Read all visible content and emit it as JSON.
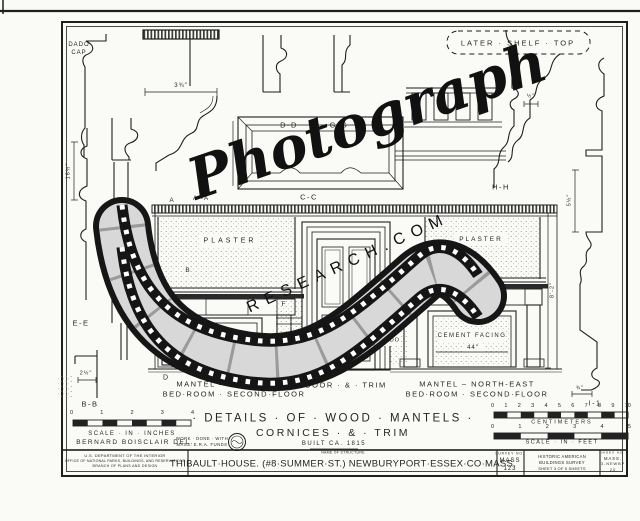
{
  "palette": {
    "paper": "#fafaf7",
    "ink": "#1f1f1f",
    "shelf": "#2a2a2a",
    "film_gray": "#d8d8d8"
  },
  "labels": {
    "dado1": "DADO",
    "dado2": "CAP",
    "later_shelf": "LATER · SHELF · TOP",
    "plaster_left": "PLASTER",
    "plaster_right": "PLASTER",
    "cement": "CEMENT FACING",
    "wood": "WOOD",
    "dado_wall": "DADO"
  },
  "sections": {
    "dd": "D-D",
    "gg": "G-G",
    "cc": "C-C",
    "hh": "H-H",
    "ee": "E-E",
    "bb": "B-B",
    "ii": "I-1"
  },
  "markers": {
    "a": "A",
    "a1": "A¹-A",
    "b": "B",
    "f": "F",
    "d": "D",
    "e": "E"
  },
  "dims": {
    "crown": "3¾″",
    "left": "16½″",
    "bb": "2½″",
    "hh": "½″",
    "right": "5½″",
    "right_b": "¾″",
    "opening": "44″",
    "height": "8'-2″",
    "door_l": "4¾″",
    "door_r": "4¾″"
  },
  "captions": {
    "left1": "MANTEL – SOUTH-EAST",
    "left2": "BED·ROOM · SECOND·FLOOR",
    "center": "DOOR · & · TRIM",
    "right1": "MANTEL – NORTH-EAST",
    "right2": "BED·ROOM · SECOND·FLOOR"
  },
  "title": {
    "line1": "· DETAILS · OF · WOOD · MANTELS ·",
    "line2": "CORNICES · & · TRIM",
    "line3": "BUILT CA. 1815"
  },
  "scales": {
    "inches": {
      "numbers": [
        "0",
        "1",
        "2",
        "3",
        "4"
      ],
      "label": "SCALE · IN · INCHES"
    },
    "centimeters": {
      "numbers": [
        "0",
        "1",
        "2",
        "3",
        "4",
        "5",
        "6",
        "7",
        "8",
        "9",
        "10"
      ],
      "label": "CENTIMETERS"
    },
    "feet": {
      "numbers": [
        "0",
        "1",
        "2",
        "3",
        "4",
        "5"
      ],
      "label": "SCALE · IN · FEET"
    }
  },
  "credits": {
    "artist": "BERNARD BOISCLAIR DEL.",
    "note1": "WORK · DONE · WITH",
    "note2": "MASS. E.R.A. FUNDS"
  },
  "titleblock": {
    "dept1": "U.S. DEPARTMENT OF THE INTERIOR",
    "dept2": "OFFICE OF NATIONAL PARKS, BUILDINGS, AND RESERVATIONS",
    "dept3": "BRANCH OF PLANS AND DESIGN",
    "name_label": "NAME OF STRUCTURE",
    "structure": "THIBAULT·HOUSE. (#8·SUMMER·ST.) NEWBURYPORT·ESSEX·CO·MASS.",
    "survey_label": "SURVEY NO.",
    "survey_line1": "MASS",
    "survey_line2": "123",
    "habs1": "HISTORIC AMERICAN",
    "habs2": "BUILDINGS SURVEY",
    "habs3": "SHEET 3 OF 5 SHEETS",
    "index_label": "INDEX NO.",
    "index1": "MASS.",
    "index2": "3-NEWBP",
    "index3": "20"
  },
  "watermark": {
    "script": "Photograph",
    "caps": "RESEARCH.COM"
  }
}
